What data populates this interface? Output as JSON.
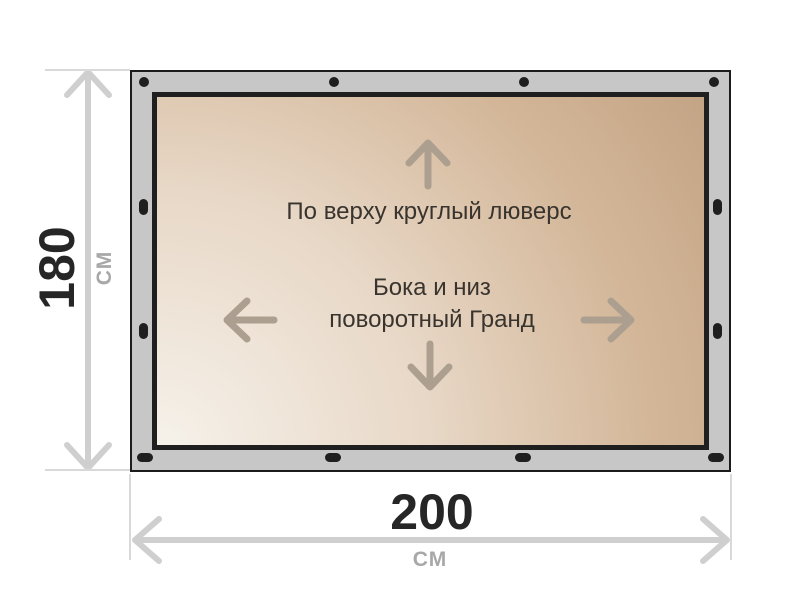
{
  "banner": {
    "top_note": "По верху круглый люверс",
    "side_note_line1": "Бока и низ",
    "side_note_line2": "поворотный Гранд",
    "grommets": {
      "top_style": "round",
      "sides_bottom_style": "oval",
      "top_count": 4,
      "bottom_count": 4,
      "left_count": 2,
      "right_count": 2
    },
    "icons": {
      "up_arrow": "up-arrow-icon",
      "down_arrow": "down-arrow-icon",
      "left_arrow": "left-arrow-icon",
      "right_arrow": "right-arrow-icon"
    }
  },
  "dimensions": {
    "height": {
      "value": "180",
      "unit": "СМ"
    },
    "width": {
      "value": "200",
      "unit": "СМ"
    }
  },
  "colors": {
    "frame_gray": "#c6c7c6",
    "frame_outline": "#1c1c1c",
    "inner_border": "#1f1f1f",
    "canvas_light": "#f6f2eb",
    "canvas_dark": "#bf9f80",
    "content_text": "#39342e",
    "content_arrow": "#ac9f8f",
    "dim_value_text": "#262626",
    "dim_unit_text": "#a8a8a8",
    "dim_line": "#cfcfcf",
    "ext_line": "#d9d9d9",
    "grommet": "#1f1f1f",
    "page_bg": "#ffffff"
  }
}
